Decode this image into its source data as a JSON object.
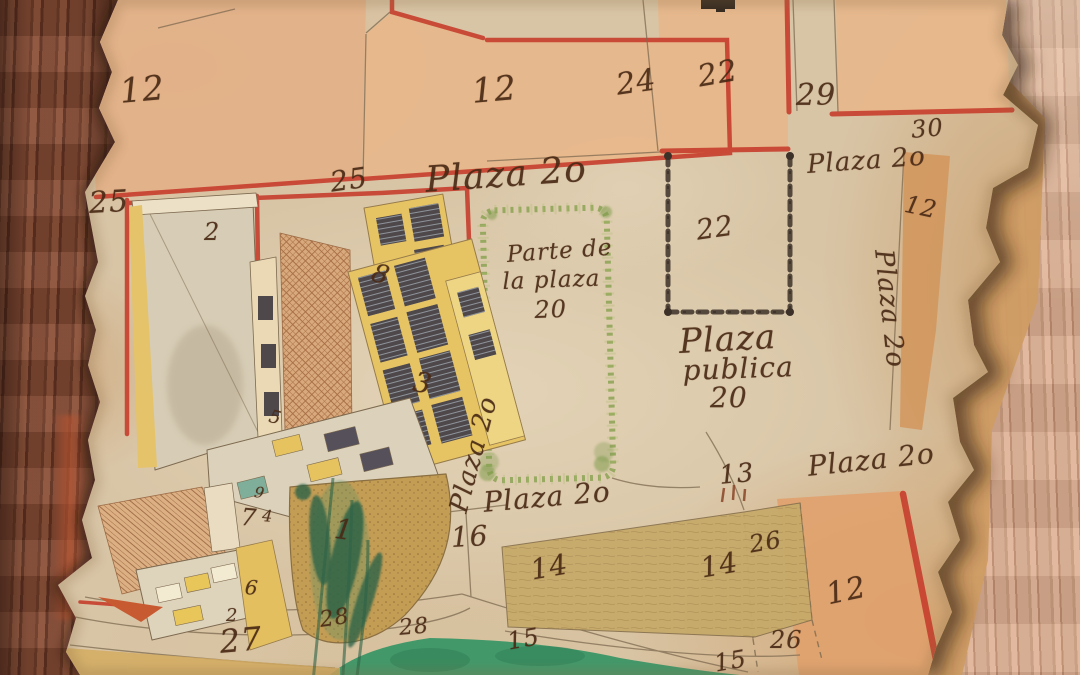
{
  "document": {
    "type": "historical hand-drawn plaza map",
    "description": "Hand-drawn colonial town-plan on torn aged parchment mounted on wood, showing numbered lots around Plaza 20 with isometric buildings"
  },
  "labels": [
    {
      "text": "12",
      "kind": "lot",
      "x": 118,
      "y": 72,
      "size": 34,
      "rotate": -5
    },
    {
      "text": "12",
      "kind": "lot",
      "x": 470,
      "y": 72,
      "size": 34,
      "rotate": -5
    },
    {
      "text": "24",
      "kind": "lot",
      "x": 614,
      "y": 68,
      "size": 30,
      "rotate": -8
    },
    {
      "text": "22",
      "kind": "lot",
      "x": 695,
      "y": 60,
      "size": 30,
      "rotate": -10
    },
    {
      "text": "29",
      "kind": "lot",
      "x": 796,
      "y": 78,
      "size": 30,
      "rotate": 0
    },
    {
      "text": "30",
      "kind": "lot",
      "x": 910,
      "y": 116,
      "size": 24,
      "rotate": -5
    },
    {
      "text": "Plaza 2o",
      "kind": "street",
      "x": 806,
      "y": 150,
      "size": 26,
      "rotate": -4
    },
    {
      "text": "12",
      "kind": "lot",
      "x": 908,
      "y": 190,
      "size": 24,
      "rotate": 12
    },
    {
      "text": "Plaza 2o",
      "kind": "street",
      "x": 898,
      "y": 248,
      "size": 26,
      "rotate": 84
    },
    {
      "text": "25",
      "kind": "lot",
      "x": 88,
      "y": 186,
      "size": 30,
      "rotate": -3
    },
    {
      "text": "25",
      "kind": "lot",
      "x": 328,
      "y": 166,
      "size": 28,
      "rotate": -8
    },
    {
      "text": "Plaza 2o",
      "kind": "street",
      "x": 424,
      "y": 160,
      "size": 36,
      "rotate": -4
    },
    {
      "text": "2",
      "kind": "lot",
      "x": 204,
      "y": 218,
      "size": 24,
      "rotate": 0
    },
    {
      "text": "22",
      "kind": "lot",
      "x": 694,
      "y": 214,
      "size": 28,
      "rotate": -8
    },
    {
      "text": "Parte de",
      "kind": "note",
      "x": 506,
      "y": 242,
      "size": 23,
      "rotate": -4
    },
    {
      "text": "la plaza",
      "kind": "note",
      "x": 502,
      "y": 269,
      "size": 23,
      "rotate": -2
    },
    {
      "text": "20",
      "kind": "note",
      "x": 534,
      "y": 296,
      "size": 24,
      "rotate": -2
    },
    {
      "text": "Plaza",
      "kind": "note",
      "x": 678,
      "y": 322,
      "size": 34,
      "rotate": -3
    },
    {
      "text": "publica",
      "kind": "note",
      "x": 682,
      "y": 354,
      "size": 28,
      "rotate": -2
    },
    {
      "text": "20",
      "kind": "note",
      "x": 710,
      "y": 381,
      "size": 28,
      "rotate": 0
    },
    {
      "text": "Plaza 2o",
      "kind": "street",
      "x": 444,
      "y": 508,
      "size": 26,
      "rotate": -75
    },
    {
      "text": "8",
      "kind": "lot",
      "x": 377,
      "y": 258,
      "size": 26,
      "rotate": 18
    },
    {
      "text": "3",
      "kind": "lot",
      "x": 417,
      "y": 365,
      "size": 28,
      "rotate": 12
    },
    {
      "text": "5",
      "kind": "lot",
      "x": 272,
      "y": 406,
      "size": 18,
      "rotate": 15
    },
    {
      "text": "9",
      "kind": "lot",
      "x": 256,
      "y": 483,
      "size": 15,
      "rotate": 10
    },
    {
      "text": "7",
      "kind": "lot",
      "x": 242,
      "y": 503,
      "size": 24,
      "rotate": 5
    },
    {
      "text": "4",
      "kind": "lot",
      "x": 263,
      "y": 506,
      "size": 16,
      "rotate": 5
    },
    {
      "text": "1",
      "kind": "lot",
      "x": 337,
      "y": 512,
      "size": 28,
      "rotate": 8
    },
    {
      "text": "6",
      "kind": "lot",
      "x": 246,
      "y": 575,
      "size": 20,
      "rotate": 5
    },
    {
      "text": "2",
      "kind": "lot",
      "x": 226,
      "y": 605,
      "size": 18,
      "rotate": 0
    },
    {
      "text": "27",
      "kind": "lot",
      "x": 218,
      "y": 623,
      "size": 32,
      "rotate": -5
    },
    {
      "text": "28",
      "kind": "lot",
      "x": 318,
      "y": 608,
      "size": 22,
      "rotate": -8
    },
    {
      "text": "28",
      "kind": "lot",
      "x": 398,
      "y": 616,
      "size": 22,
      "rotate": -5
    },
    {
      "text": "16",
      "kind": "lot",
      "x": 450,
      "y": 521,
      "size": 28,
      "rotate": -3
    },
    {
      "text": "Plaza 2o",
      "kind": "street",
      "x": 482,
      "y": 486,
      "size": 28,
      "rotate": -5
    },
    {
      "text": "13",
      "kind": "lot",
      "x": 718,
      "y": 461,
      "size": 26,
      "rotate": -5
    },
    {
      "text": "14",
      "kind": "lot",
      "x": 528,
      "y": 554,
      "size": 28,
      "rotate": -10
    },
    {
      "text": "14",
      "kind": "lot",
      "x": 698,
      "y": 552,
      "size": 28,
      "rotate": -10
    },
    {
      "text": "26",
      "kind": "lot",
      "x": 747,
      "y": 531,
      "size": 24,
      "rotate": -10
    },
    {
      "text": "26",
      "kind": "lot",
      "x": 770,
      "y": 626,
      "size": 24,
      "rotate": 0
    },
    {
      "text": "12",
      "kind": "lot",
      "x": 823,
      "y": 578,
      "size": 30,
      "rotate": -12
    },
    {
      "text": "15",
      "kind": "lot",
      "x": 505,
      "y": 628,
      "size": 24,
      "rotate": -10
    },
    {
      "text": "15",
      "kind": "lot",
      "x": 712,
      "y": 650,
      "size": 24,
      "rotate": -10
    },
    {
      "text": "Plaza 2o",
      "kind": "street",
      "x": 806,
      "y": 450,
      "size": 28,
      "rotate": -6
    }
  ],
  "palette": {
    "parchment": "#d8c5a6",
    "parchment_light": "#e4d4ba",
    "parchment_dark": "#c2a075",
    "block_fill": "#e7b78b",
    "block_outline": "#c7402f",
    "ink": "#4a2a15",
    "pencil": "#7d6a50",
    "building_yellow": "#e7c463",
    "window_dark": "#4e484b",
    "brick": "#d8a97c",
    "bastion_tan": "#c49d55",
    "lot_khaki": "#c6aa6a",
    "bottom_lot_fill": "#dfa26e",
    "grass_green": "#43986a",
    "tree_green": "#2d6347",
    "plaza_border_green": "#86a04e",
    "wood_left": "#7c4531",
    "wood_right": "#d2a285",
    "burn_shadow": "#2e1c0f"
  }
}
